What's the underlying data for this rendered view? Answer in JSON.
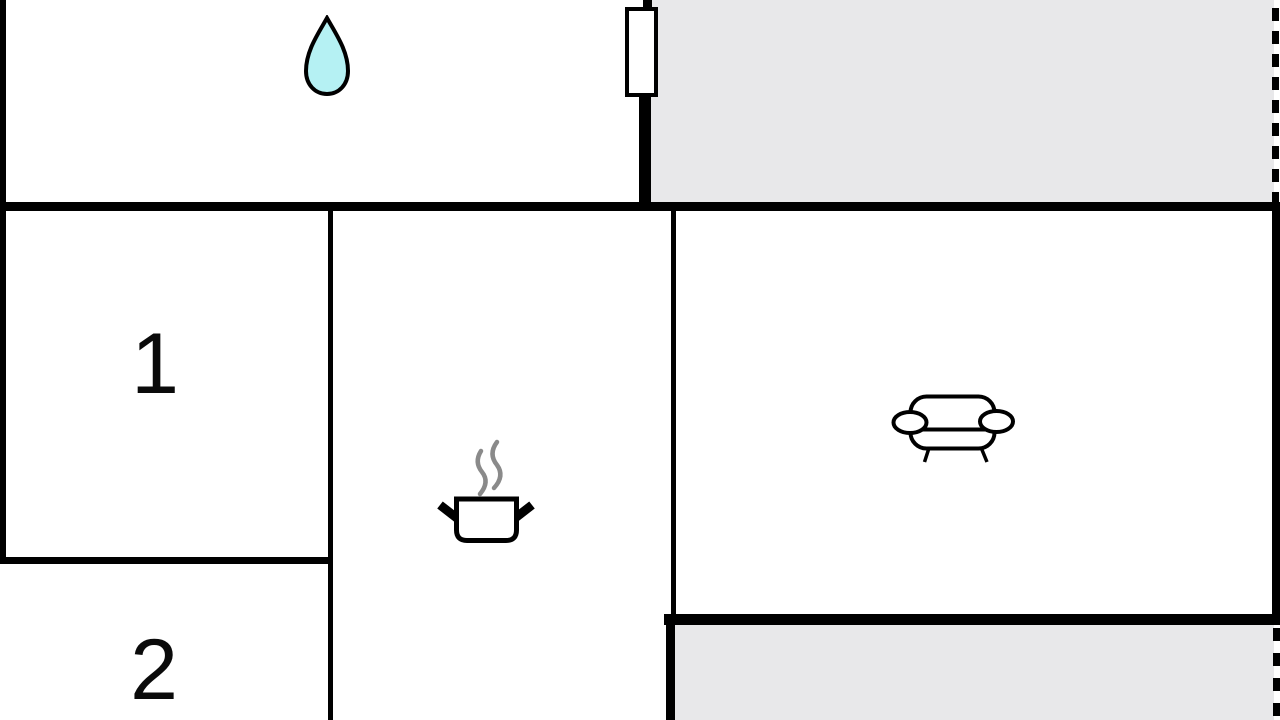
{
  "rooms": {
    "room1_label": "1",
    "room2_label": "2"
  },
  "icons": [
    "water-drop-icon",
    "radiator-icon",
    "cooking-pot-icon",
    "sofa-icon"
  ],
  "colors": {
    "background": "#ffffff",
    "wall": "#000000",
    "terrace_fill": "#e8e8ea",
    "water_drop_fill": "#b5f1f3",
    "steam": "#8a8a8a",
    "label": "#0a0a0a"
  }
}
